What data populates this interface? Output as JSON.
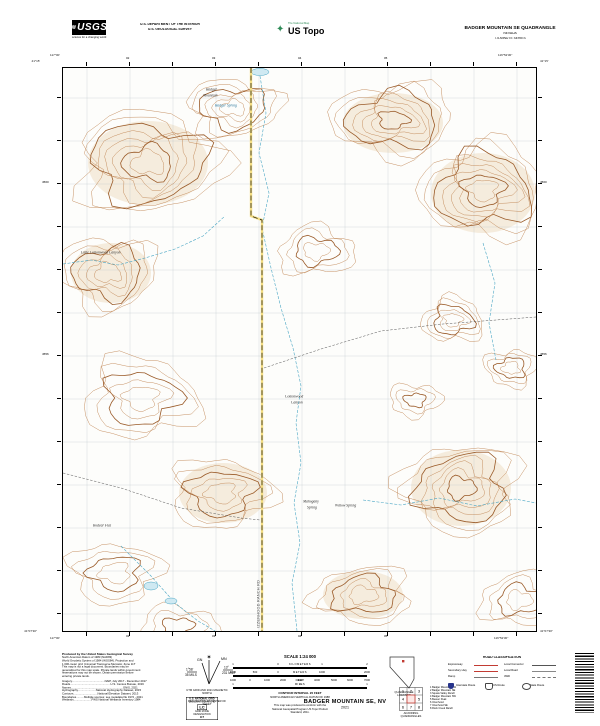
{
  "header": {
    "usgs_logo_text": "USGS",
    "usgs_wave_icon": "≋",
    "usgs_tagline": "science for a changing world",
    "dept_line1": "U.S. DEPARTMENT OF THE INTERIOR",
    "dept_line2": "U.S. GEOLOGICAL SURVEY",
    "ustopo_tagline": "The National Map",
    "ustopo_brand": "US Topo",
    "ustopo_icon": "✦",
    "quad_title": "BADGER MOUNTAIN SE QUADRANGLE",
    "quad_state": "NEVADA",
    "quad_series": "7.5-MINUTE SERIES"
  },
  "collar": {
    "corner_top_left_lat": "41°15'",
    "corner_top_left_lon": "117°00'",
    "corner_top_right_lat": "41°15'",
    "corner_top_right_lon": "116°52'30\"",
    "corner_bottom_left_lat": "41°07'30\"",
    "corner_bottom_left_lon": "117°00'",
    "corner_bottom_right_lat": "41°07'30\"",
    "corner_bottom_right_lon": "116°52'30\"",
    "top_ticks": [
      "02",
      "03",
      "04",
      "05"
    ],
    "bottom_ticks": [
      "02",
      "03",
      "04",
      "05"
    ],
    "left_ticks": [
      "4560",
      "4556"
    ],
    "right_ticks": [
      "4560",
      "4556"
    ]
  },
  "map": {
    "labels": [
      {
        "text": "Badger",
        "x": 143,
        "y": 20,
        "cls": "feature"
      },
      {
        "text": "Mountain",
        "x": 140,
        "y": 26,
        "cls": "feature"
      },
      {
        "text": "Badger Spring",
        "x": 152,
        "y": 36,
        "cls": "water"
      },
      {
        "text": "Little Cottonwood Canyon",
        "x": 18,
        "y": 183,
        "cls": "feature"
      },
      {
        "text": "Cottonwood",
        "x": 222,
        "y": 327,
        "cls": "feature"
      },
      {
        "text": "Canyon",
        "x": 228,
        "y": 333,
        "cls": "feature"
      },
      {
        "text": "Mahogany",
        "x": 240,
        "y": 432,
        "cls": "feature"
      },
      {
        "text": "Spring",
        "x": 244,
        "y": 438,
        "cls": "feature"
      },
      {
        "text": "Willow Spring",
        "x": 272,
        "y": 436,
        "cls": "feature"
      },
      {
        "text": "Rodear Flat",
        "x": 30,
        "y": 456,
        "cls": "feature"
      },
      {
        "text": "IZZENHOOD RANCH RD",
        "x": 194,
        "y": 560,
        "cls": "road",
        "rotate": -90
      }
    ]
  },
  "footer": {
    "credits": {
      "title": "Produced by the United States Geological Survey",
      "lines": [
        "North American Datum of 1983 (NAD83)",
        "World Geodetic System of 1984 (WGS84).  Projection and",
        "1 000-meter grid: Universal Transverse Mercator, Zone 11T",
        "This map is not a legal document. Boundaries may be",
        "generalized for this map scale. Private lands within government",
        "reservations may not be shown. Obtain permission before",
        "entering private lands."
      ],
      "sources": [
        "Imagery..........................................NAIP, July 2017 - December 2017",
        "Roads....................................................U.S. Census Bureau, 2016",
        "Names...................................................................GNIS, 2021",
        "Hydrography.......................National Hydrography Dataset, 2015",
        "Contours...............................National Elevation Dataset, 2013",
        "Boundaries..........Multiple sources; see metadata file 1972 - 2021",
        "Wetlands.......................FWS National Wetlands Inventory 1984"
      ]
    },
    "declination": {
      "star": "✶",
      "gn_label": "GN",
      "mn_label": "MN",
      "gn_deg": "1°58´",
      "gn_mils": "35 MILS",
      "mn_deg": "13°",
      "mn_mils": "231 MILS",
      "caption_line1": "UTM GRID AND 2021 MAGNETIC NORTH",
      "caption_line2": "DECLINATION AT CENTER OF SHEET"
    },
    "usng": {
      "title": "U.S. NATIONAL GRID",
      "subtitle": "100,000-M SQUARE ID",
      "square_id": "LC",
      "zone_label": "GRID ZONE DESIGNATION",
      "zone": "11T"
    },
    "scale": {
      "title": "SCALE 1:24 000",
      "units_km": "KILOMETERS",
      "units_m": "METERS",
      "units_mi": "MILES",
      "units_ft": "FEET",
      "km_numbers": [
        "1",
        "0",
        "1",
        "2"
      ],
      "m_numbers": [
        "1000",
        "500",
        "0",
        "1000",
        "2000"
      ],
      "ft_numbers": [
        "1000",
        "0",
        "1000",
        "2000",
        "3000",
        "4000",
        "5000",
        "6000",
        "7000"
      ],
      "mi_numbers": [
        "1",
        "0",
        "1"
      ],
      "contour_interval": "CONTOUR INTERVAL 20 FEET",
      "vertical_datum": "NORTH AMERICAN VERTICAL DATUM OF 1988",
      "conform_line1": "This map was produced to conform with the",
      "conform_line2": "National Geospatial Program US Topo Product Standard, 2011."
    },
    "location_caption": "QUADRANGLE LOCATION",
    "adjoining": {
      "caption": "ADJOINING QUADRANGLES",
      "cells": [
        "1",
        "2",
        "3",
        "4",
        "5",
        "6",
        "7",
        "8"
      ],
      "names": [
        "1 Badger Mountain NW",
        "2 Badger Mountain NE",
        "3 Squaw Valley Ranch",
        "4 Badger Mountain SW",
        "5 Beaver Peak",
        "6 Izzenhood",
        "7 Izzenhood SE",
        "8 Rock Creek Ranch"
      ]
    },
    "road_classification": {
      "title": "ROAD CLASSIFICATION",
      "left_labels": [
        "Expressway",
        "Secondary Hwy",
        "Ramp"
      ],
      "right_labels": [
        "Local Connector",
        "Local Road",
        "4WD"
      ],
      "shield_labels": [
        "Interstate Route",
        "US Route",
        "State Route"
      ]
    },
    "sheet_title": "BADGER MOUNTAIN SE,  NV",
    "sheet_year": "2021"
  },
  "colors": {
    "contour": "#c08552",
    "contour_index": "#9a5a28",
    "shade": "#eedcbf",
    "water": "#4aa6c4",
    "water_fill": "#cfe9f2",
    "grid": "#b6bfc7",
    "road_yellow": "#f5df85",
    "legend_red": "#c23b33",
    "interstate_blue": "#27348b"
  }
}
